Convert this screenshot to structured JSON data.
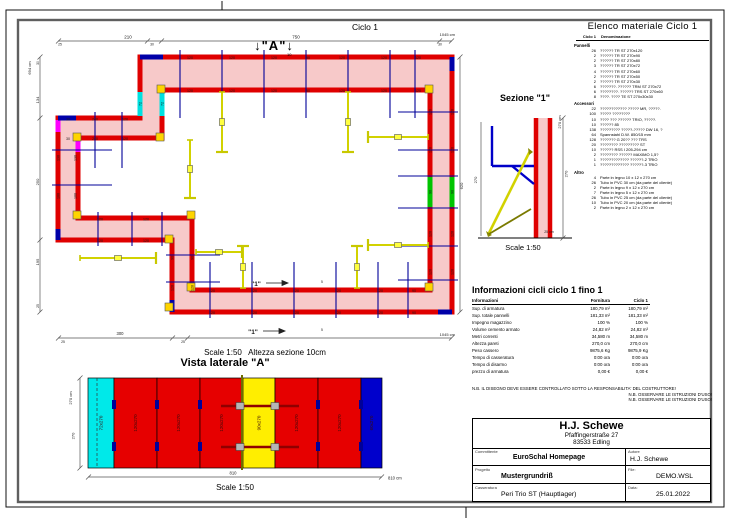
{
  "page": {
    "plan_title": "Ciclo 1",
    "marker_a": "↓\"A\"↓",
    "marker_a_sub": "10",
    "plan_scale_note": "Scale 1:50   Altezza sezione 10cm",
    "sideview_title": "Vista laterale \"A\"",
    "sideview_scale": "Scale 1:50",
    "section_title": "Sezione \"1\"",
    "section_scale": "Scale 1:50"
  },
  "plan": {
    "labels": [
      {
        "t": "120",
        "x": 190,
        "y": 59
      },
      {
        "t": "120",
        "x": 232,
        "y": 59
      },
      {
        "t": "120",
        "x": 274,
        "y": 59
      },
      {
        "t": "90",
        "x": 308,
        "y": 59
      },
      {
        "t": "120",
        "x": 342,
        "y": 59
      },
      {
        "t": "120",
        "x": 384,
        "y": 59
      },
      {
        "t": "120",
        "x": 418,
        "y": 59
      },
      {
        "t": "120",
        "x": 190,
        "y": 92
      },
      {
        "t": "120",
        "x": 232,
        "y": 92
      },
      {
        "t": "120",
        "x": 274,
        "y": 92
      },
      {
        "t": "90",
        "x": 308,
        "y": 92
      },
      {
        "t": "120",
        "x": 342,
        "y": 92
      },
      {
        "t": "120",
        "x": 384,
        "y": 92
      },
      {
        "t": "120",
        "x": 418,
        "y": 92
      },
      {
        "t": "120",
        "x": 431.5,
        "y": 112,
        "r": -90
      },
      {
        "t": "120",
        "x": 431.5,
        "y": 150,
        "r": -90
      },
      {
        "t": "90",
        "x": 431.5,
        "y": 192,
        "r": -90
      },
      {
        "t": "120",
        "x": 431.5,
        "y": 234,
        "r": -90
      },
      {
        "t": "120",
        "x": 431.5,
        "y": 272,
        "r": -90
      },
      {
        "t": "120",
        "x": 453.5,
        "y": 112,
        "r": -90
      },
      {
        "t": "120",
        "x": 453.5,
        "y": 150,
        "r": -90
      },
      {
        "t": "90",
        "x": 453.5,
        "y": 192,
        "r": -90
      },
      {
        "t": "120",
        "x": 453.5,
        "y": 234,
        "r": -90
      },
      {
        "t": "120",
        "x": 453.5,
        "y": 272,
        "r": -90
      },
      {
        "t": "120",
        "x": 212,
        "y": 292
      },
      {
        "t": "120",
        "x": 254,
        "y": 292
      },
      {
        "t": "120",
        "x": 296,
        "y": 292
      },
      {
        "t": "120",
        "x": 338,
        "y": 292
      },
      {
        "t": "120",
        "x": 380,
        "y": 292
      },
      {
        "t": "90",
        "x": 414,
        "y": 292
      },
      {
        "t": "120",
        "x": 212,
        "y": 314
      },
      {
        "t": "120",
        "x": 254,
        "y": 314
      },
      {
        "t": "120",
        "x": 296,
        "y": 314
      },
      {
        "t": "120",
        "x": 338,
        "y": 314
      },
      {
        "t": "120",
        "x": 380,
        "y": 314
      },
      {
        "t": "90",
        "x": 414,
        "y": 314
      },
      {
        "t": "130",
        "x": 59.5,
        "y": 158,
        "r": -90
      },
      {
        "t": "100",
        "x": 59.5,
        "y": 196,
        "r": -90
      },
      {
        "t": "130",
        "x": 76.5,
        "y": 158,
        "r": -90
      },
      {
        "t": "100",
        "x": 76.5,
        "y": 196,
        "r": -90
      },
      {
        "t": "30",
        "x": 68,
        "y": 120.5
      },
      {
        "t": "240",
        "x": 95,
        "y": 120.5
      },
      {
        "t": "120",
        "x": 125,
        "y": 120.5
      },
      {
        "t": "30",
        "x": 68,
        "y": 140
      },
      {
        "t": "240",
        "x": 95,
        "y": 140
      },
      {
        "t": "120",
        "x": 125,
        "y": 140
      },
      {
        "t": "120",
        "x": 100,
        "y": 220.5
      },
      {
        "t": "120",
        "x": 146,
        "y": 220.5
      },
      {
        "t": "120",
        "x": 100,
        "y": 242
      },
      {
        "t": "120",
        "x": 146,
        "y": 242
      },
      {
        "t": "90",
        "x": 173.5,
        "y": 258,
        "r": -90
      },
      {
        "t": "120",
        "x": 173.5,
        "y": 288,
        "r": -90
      },
      {
        "t": "90",
        "x": 193.5,
        "y": 258,
        "r": -90
      },
      {
        "t": "120",
        "x": 193.5,
        "y": 288,
        "r": -90
      },
      {
        "t": "72",
        "x": 141.5,
        "y": 104,
        "r": -90
      },
      {
        "t": "72",
        "x": 163.5,
        "y": 104,
        "r": -90
      },
      {
        "t": "210",
        "x": 128,
        "y": 38.5,
        "s": 4.5
      },
      {
        "t": "750",
        "x": 296,
        "y": 38.5,
        "s": 4.5
      },
      {
        "t": "25",
        "x": 60,
        "y": 45.5,
        "s": 3.4
      },
      {
        "t": "30",
        "x": 152,
        "y": 45.5,
        "s": 3.4
      },
      {
        "t": "30",
        "x": 440,
        "y": 45.5,
        "s": 3.4
      },
      {
        "t": "1045 cm",
        "x": 455,
        "y": 36,
        "s": 4,
        "a": "end"
      },
      {
        "t": "694 cm",
        "x": 31,
        "y": 68,
        "r": -90,
        "s": 4
      },
      {
        "t": "30",
        "x": 39,
        "y": 63,
        "r": -90,
        "s": 3.4
      },
      {
        "t": "134",
        "x": 39,
        "y": 100,
        "r": -90,
        "s": 4
      },
      {
        "t": "250",
        "x": 39,
        "y": 182,
        "r": -90,
        "s": 4
      },
      {
        "t": "195",
        "x": 39,
        "y": 262,
        "r": -90,
        "s": 4
      },
      {
        "t": "25",
        "x": 39,
        "y": 306,
        "r": -90,
        "s": 3.4
      },
      {
        "t": "620",
        "x": 463,
        "y": 186,
        "r": -90,
        "s": 4
      },
      {
        "t": "300",
        "x": 120,
        "y": 335,
        "s": 4.2
      },
      {
        "t": "25",
        "x": 63,
        "y": 343,
        "s": 3.4
      },
      {
        "t": "25",
        "x": 183,
        "y": 343,
        "s": 3.4
      },
      {
        "t": "1045 cm",
        "x": 455,
        "y": 336,
        "s": 4,
        "a": "end"
      },
      {
        "t": "\"1\"",
        "x": 256,
        "y": 286,
        "s": 6.5,
        "b": 1
      },
      {
        "t": "\"1\"",
        "x": 253,
        "y": 334,
        "s": 6.5,
        "b": 1
      },
      {
        "t": "5",
        "x": 322,
        "y": 283,
        "s": 3.4
      },
      {
        "t": "5",
        "x": 322,
        "y": 331,
        "s": 3.4
      }
    ]
  },
  "section": {
    "labels": [
      {
        "t": "270",
        "x": 477,
        "y": 180,
        "r": -90,
        "s": 4
      },
      {
        "t": "270 cm",
        "x": 561,
        "y": 122,
        "r": -90,
        "s": 4
      },
      {
        "t": "270",
        "x": 567.5,
        "y": 174,
        "r": -90,
        "s": 4
      },
      {
        "t": "25 cm",
        "x": 549,
        "y": 233,
        "s": 3.5
      }
    ]
  },
  "side_view": {
    "panels": [
      {
        "label": "72x270",
        "color": "#00e9e9",
        "w": 26
      },
      {
        "label": "120x270",
        "color": "#e60000",
        "w": 43
      },
      {
        "label": "120x270",
        "color": "#e60000",
        "w": 43
      },
      {
        "label": "120x270",
        "color": "#e60000",
        "w": 43
      },
      {
        "label": "90x270",
        "color": "#ffee00",
        "w": 32
      },
      {
        "label": "120x270",
        "color": "#e60000",
        "w": 43
      },
      {
        "label": "120x270",
        "color": "#e60000",
        "w": 43
      },
      {
        "label": "60x270",
        "color": "#0000cc",
        "w": 21
      }
    ],
    "labels": [
      {
        "t": "270 cm",
        "x": 72,
        "y": 398,
        "r": -90,
        "s": 4
      },
      {
        "t": "270",
        "x": 74.5,
        "y": 436,
        "r": -90,
        "s": 4
      },
      {
        "t": "810",
        "x": 233,
        "y": 474.5,
        "s": 4.2
      },
      {
        "t": "810 cm",
        "x": 388,
        "y": 479.5,
        "s": 4.2,
        "a": "start"
      }
    ]
  },
  "material_list": {
    "title": "Elenco materiale  Ciclo 1",
    "col1": "Ciclo 1",
    "col2": "Denominazione",
    "sections": [
      {
        "name": "Pannelli",
        "items": [
          {
            "qty": "26",
            "desc": "?????? TR ST 270x120"
          },
          {
            "qty": "2",
            "desc": "?????? TR ST 270x90"
          },
          {
            "qty": "2",
            "desc": "?????? TR ST 270x80"
          },
          {
            "qty": "3",
            "desc": "?????? TR ST 270x72"
          },
          {
            "qty": "4",
            "desc": "?????? TR ST 270x60"
          },
          {
            "qty": "2",
            "desc": "?????? TR ST 270x50"
          },
          {
            "qty": "2",
            "desc": "?????? TR ST 270x30"
          },
          {
            "qty": "6",
            "desc": "???????. ?????? TRM ST 270x72"
          },
          {
            "qty": "6",
            "desc": "????????. ?????? TRS ST 270x60"
          },
          {
            "qty": "8",
            "desc": "????. ???? TE ST 270x30x30"
          }
        ]
      },
      {
        "name": "Accessori",
        "items": [
          {
            "qty": "22",
            "desc": "???????????? ????? MR, ?????."
          },
          {
            "qty": "100",
            "desc": "????? ????????"
          },
          {
            "qty": "10",
            "desc": "???? ??? ?????? TRIO, ?????."
          },
          {
            "qty": "10",
            "desc": "?????? 85"
          },
          {
            "qty": "138",
            "desc": "????????? ?????-????? DW 16, ?"
          },
          {
            "qty": "64",
            "desc": "Spannstahl  D.W. 850/15 mm"
          },
          {
            "qty": "128",
            "desc": "??????? G 20?? ??? TRS"
          },
          {
            "qty": "20",
            "desc": "???????? ????????? ST"
          },
          {
            "qty": "10",
            "desc": "?????? RSS I  205-294 cm"
          },
          {
            "qty": "2",
            "desc": "???????? ?????? MAXIMO 1,5?"
          },
          {
            "qty": "1",
            "desc": "????????????? ??????-2 TRIO"
          },
          {
            "qty": "1",
            "desc": "????????????? ??????-3 TRIO"
          }
        ]
      },
      {
        "name": "Altro",
        "items": [
          {
            "qty": "4",
            "desc": "Parte in legno 10 x 12 x 270 cm"
          },
          {
            "qty": "26",
            "desc": "Tubo in PVC 30 cm (da parte del cliente)"
          },
          {
            "qty": "2",
            "desc": "Parte in legno 9 x 12 x 270 cm"
          },
          {
            "qty": "7",
            "desc": "Parte in legno 5 x 12 x 270 cm"
          },
          {
            "qty": "26",
            "desc": "Tubo in PVC 25 cm (da parte del cliente)"
          },
          {
            "qty": "10",
            "desc": "Tubo in PVC 20 cm (da parte del cliente)"
          },
          {
            "qty": "2",
            "desc": "Parte in legno 2 x 12 x 270 cm"
          }
        ]
      }
    ]
  },
  "cycle_info": {
    "title": "Informazioni cicli  ciclo 1 fino 1",
    "headers": [
      "Informazioni",
      "Fornitura",
      "Ciclo 1"
    ],
    "rows": [
      [
        "Sup. di armatura",
        "180,79 m²",
        "180,79 m²"
      ],
      [
        "Sup. totale pannelli",
        "181,33 m²",
        "181,33 m²"
      ],
      [
        "Impegno magazzino",
        "100 %",
        "100 %"
      ],
      [
        "Volume cemento armato",
        "24,82 m³",
        "24,82 m³"
      ],
      [
        "Metri correnti",
        "34,580 m",
        "34,580 m"
      ],
      [
        "Altezza pareti",
        "270,0 cm",
        "270,0 cm"
      ],
      [
        "Peso cassero",
        "9875,6 Kg",
        "9875,9 Kg"
      ],
      [
        "Tempo di casseratura",
        "0:00 ora",
        "0:00 ora"
      ],
      [
        "Tempo di disarmo",
        "0:00 ora",
        "0:00 ora"
      ],
      [
        "prezzo di armatura",
        "0,00 €",
        "0,00 €"
      ]
    ]
  },
  "notes": {
    "line1": "N.B. IL DISEGNO DEVE ESSERE CONTROLLATO SOTTO LA RESPONSABILITA' DEL COSTRUTTORE!",
    "line2": "N.B. OSSERVARE LE ISTRUZIONI D'USO!",
    "line3": "N.B. OSSERVARE LE ISTRUZIONI D'USO!"
  },
  "title_block": {
    "company": "H.J. Schewe",
    "address1": "Pfaffingerstraße 27",
    "address2": "83533 Edling",
    "rows": [
      {
        "label": "Committente",
        "value": "EuroSchal Homepage"
      },
      {
        "label": "Progetto",
        "value": "Mustergrundriß"
      },
      {
        "label": "Casseratura",
        "value": "Peri Trio ST (Hauptlager)"
      }
    ],
    "right_rows": [
      {
        "label": "Autore",
        "value": "H.J. Schewe"
      },
      {
        "label": "File:",
        "value": "DEMO.WSL"
      },
      {
        "label": "Data:",
        "value": "25.01.2022"
      }
    ]
  }
}
